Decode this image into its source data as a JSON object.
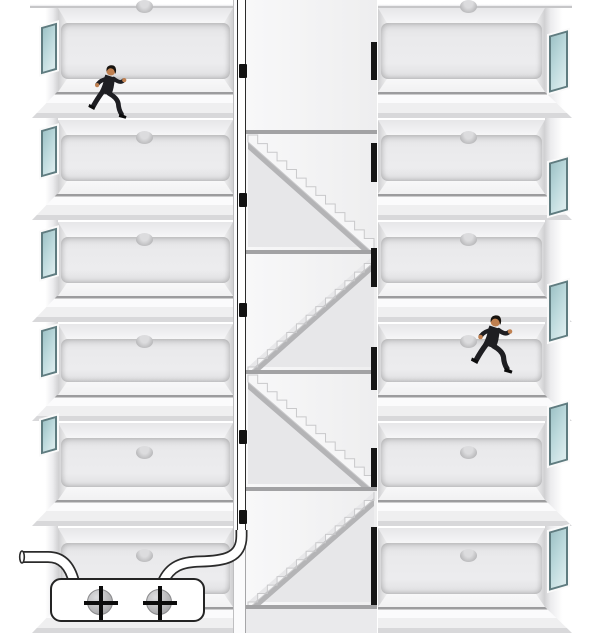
{
  "meta": {
    "description": "Cross-section illustration of a six-level building: two men in dark suits run leftward along corridors, a central stairwell zigzags between landings behind doors with black handles, dark open doorways lead to the right wing, and a white control box with two plus-marked buttons feeds a white pipe that rises up the stair shaft."
  },
  "palette": {
    "background": "#ffffff",
    "room_wall": "#ececee",
    "room_wall_edge": "#d2d2d4",
    "slab_line": "#9c9c9e",
    "shaft_bg": "#f4f4f5",
    "shaft_under_stairs": "#e7e7e9",
    "stair_stringer": "#b4b4b6",
    "stair_step_edge": "#c9c9cb",
    "landing_line": "#a2a2a4",
    "window_glass": "#bcd9dc",
    "window_frame": "#5f7c80",
    "door_handle": "#121212",
    "open_door": "#161616",
    "tube_fill": "#ffffff",
    "tube_outline": "#2b2b2b",
    "panel_fill": "#ffffff",
    "panel_outline": "#242424",
    "screw_fill": "#b9b9bb",
    "screw_edge": "#8a8a8c",
    "plus": "#0c0c0c",
    "lamp_top": "#dcdcde",
    "lamp_bottom": "#a4a4a6",
    "suit": "#1e1e22",
    "skin": "#c08050",
    "hair": "#17130f"
  },
  "layout": {
    "width": 607,
    "height": 633,
    "left_wall": {
      "x": 30,
      "w": 28,
      "h": 628
    },
    "right_wall": {
      "x": 545,
      "w": 32,
      "h": 625
    },
    "left_rooms": {
      "x": 58,
      "w": 175
    },
    "right_rooms": {
      "x": 378,
      "w": 167
    },
    "top_band_h": 8,
    "slab_tops": [
      92,
      194,
      296,
      395,
      500,
      607
    ],
    "slab_h": 26,
    "room_tops": [
      8,
      120,
      222,
      324,
      423,
      528
    ],
    "left_slab_x": 30,
    "left_slab_w": 203,
    "right_slab_x": 378,
    "right_slab_w": 194,
    "stairwell": {
      "door_col_x": 233,
      "door_col_w": 13,
      "shaft_x": 246,
      "shaft_w": 131,
      "right_x": 377,
      "landings": [
        130,
        250,
        370,
        487,
        605
      ],
      "flights": [
        {
          "top": 130,
          "bottom": 250,
          "dir": "down-right"
        },
        {
          "top": 250,
          "bottom": 370,
          "dir": "down-left"
        },
        {
          "top": 370,
          "bottom": 487,
          "dir": "down-right"
        },
        {
          "top": 487,
          "bottom": 605,
          "dir": "down-left"
        }
      ],
      "steps_per_flight": 13,
      "handles": [
        64,
        193,
        303,
        430,
        510
      ],
      "handle_x": 239,
      "handle_w": 8,
      "handle_h": 14,
      "open_doors": [
        {
          "y": 42,
          "h": 38
        },
        {
          "y": 143,
          "h": 39
        },
        {
          "y": 248,
          "h": 39
        },
        {
          "y": 347,
          "h": 43
        },
        {
          "y": 448,
          "h": 39
        },
        {
          "y": 527,
          "h": 78
        }
      ],
      "open_door_x": 371,
      "open_door_w": 6,
      "pipe_x": 236.5,
      "pipe_w": 9.5,
      "pipe_bottom": 536
    },
    "left_windows": [
      {
        "y": 25,
        "h": 47
      },
      {
        "y": 128,
        "h": 47
      },
      {
        "y": 230,
        "h": 47
      },
      {
        "y": 328,
        "h": 47
      },
      {
        "y": 418,
        "h": 34
      }
    ],
    "left_window_x": 41,
    "left_window_w": 16,
    "right_windows": [
      {
        "y": 33,
        "h": 57
      },
      {
        "y": 160,
        "h": 53
      },
      {
        "y": 283,
        "h": 56
      },
      {
        "y": 405,
        "h": 58
      },
      {
        "y": 529,
        "h": 59
      }
    ],
    "right_window_x": 549,
    "right_window_w": 19,
    "lamps_y": [
      0,
      131,
      233,
      335,
      446,
      549
    ],
    "left_lamp_x": 136,
    "right_lamp_x": 460,
    "lamp_w": 17,
    "lamp_h": 13
  },
  "figures": [
    {
      "id": "runner-left-top",
      "x": 86,
      "y": 64,
      "w": 48,
      "h": 57,
      "facing": "left",
      "floor": 1,
      "wing": "left"
    },
    {
      "id": "runner-right-middle",
      "x": 470,
      "y": 314,
      "w": 49,
      "h": 62,
      "facing": "left",
      "floor": 4,
      "wing": "right"
    }
  ],
  "machine": {
    "x": 50,
    "y": 578,
    "w": 155,
    "h": 44,
    "buttons": [
      {
        "cx": 98,
        "cy": 600,
        "r": 13,
        "symbol": "+"
      },
      {
        "cx": 157,
        "cy": 600,
        "r": 13,
        "symbol": "+"
      }
    ],
    "left_tube_end_x": 22,
    "left_tube_y": 557,
    "right_tube_join_x": 241.5
  }
}
